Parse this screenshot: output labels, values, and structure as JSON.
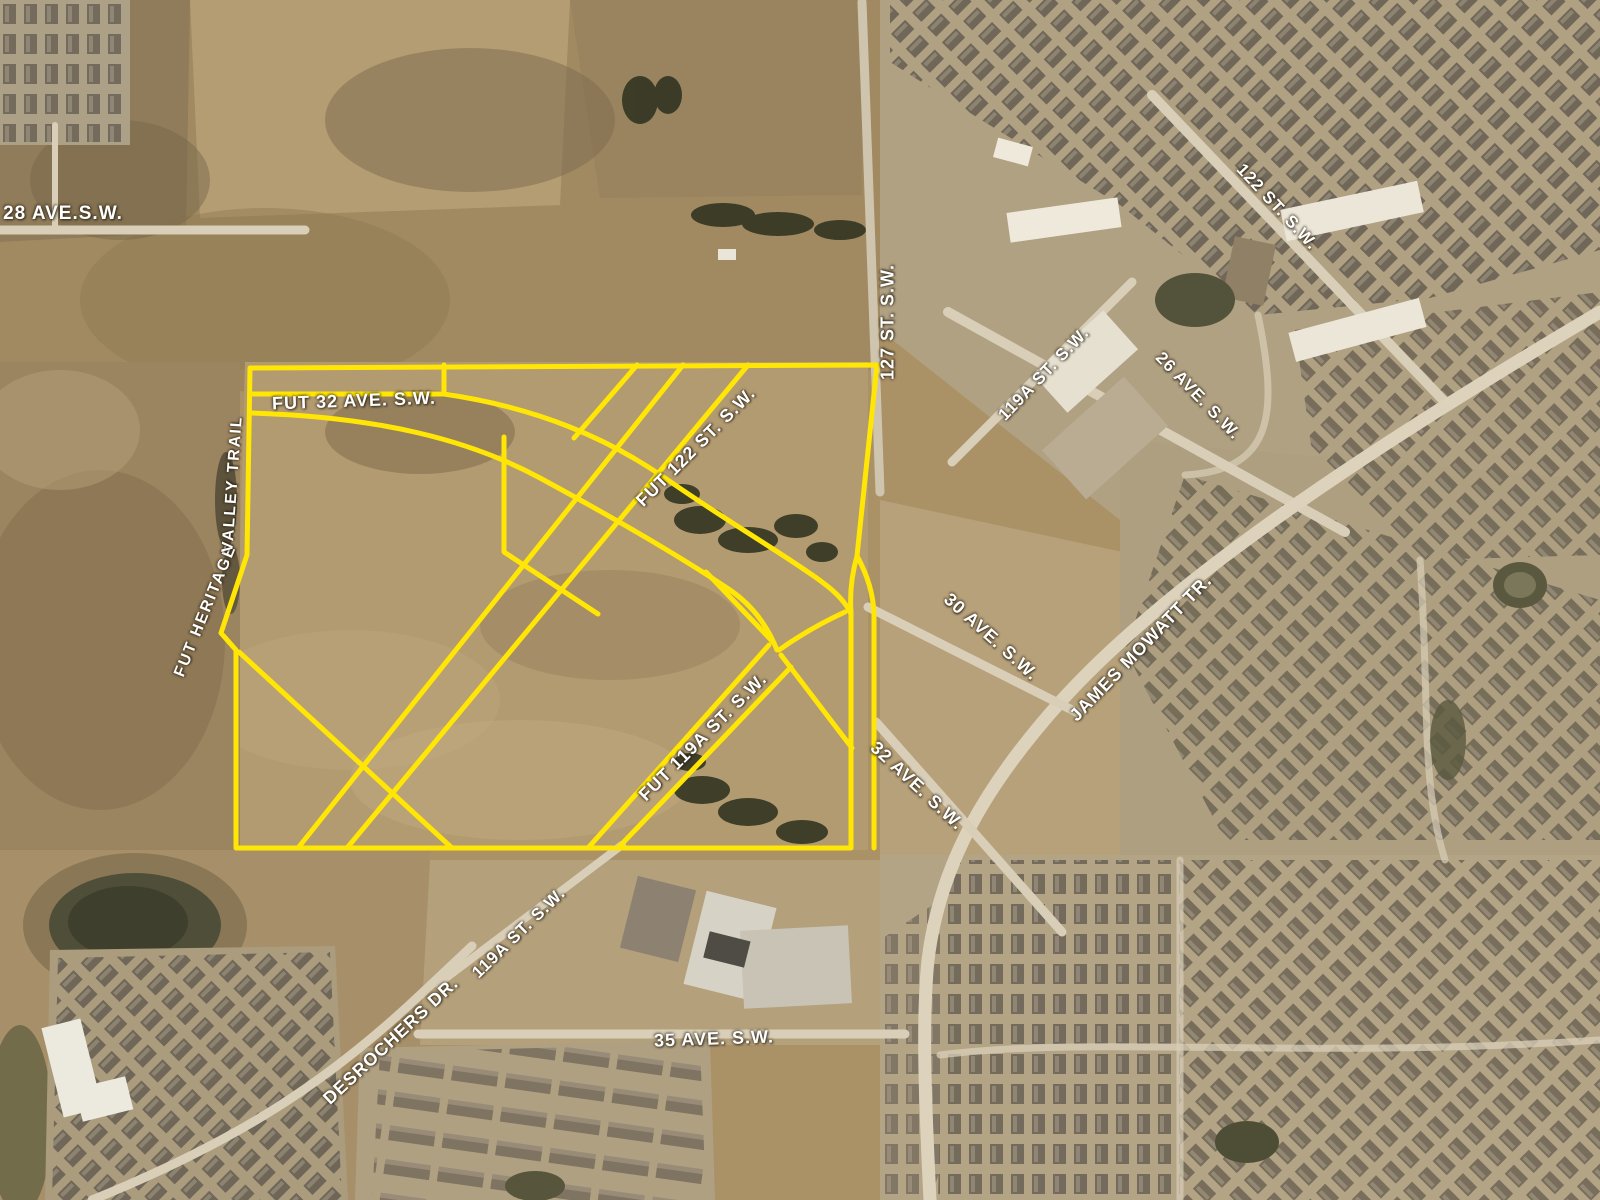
{
  "map": {
    "type": "aerial-imagery-with-development-boundary",
    "colors": {
      "annotation_yellow": "#ffe604",
      "label_white": "#ffffff"
    },
    "road_labels": [
      {
        "id": "ave-28",
        "text": "28 AVE.S.W."
      },
      {
        "id": "fut-32-ave",
        "text": "FUT 32 AVE. S.W."
      },
      {
        "id": "fut-heritage",
        "text": "FUT  HERITAGE"
      },
      {
        "id": "valley-trail",
        "text": "VALLEY  TRAIL"
      },
      {
        "id": "st-127",
        "text": "127 ST. S.W."
      },
      {
        "id": "fut-122-st",
        "text": "FUT 122 ST. S.W."
      },
      {
        "id": "st-119a-north",
        "text": "119A ST. S.W."
      },
      {
        "id": "ave-26",
        "text": "26 AVE. S.W."
      },
      {
        "id": "st-122",
        "text": "122 ST. S.W."
      },
      {
        "id": "ave-30",
        "text": "30 AVE. S.W."
      },
      {
        "id": "james-mowatt-tr",
        "text": "JAMES MOWATT TR."
      },
      {
        "id": "ave-32",
        "text": "32 AVE. S.W."
      },
      {
        "id": "fut-119a-st",
        "text": "FUT 119A ST. S.W."
      },
      {
        "id": "st-119a-south",
        "text": "119A ST. S.W."
      },
      {
        "id": "desrochers-dr",
        "text": "DESROCHERS DR."
      },
      {
        "id": "ave-35",
        "text": "35 AVE. S.W."
      }
    ]
  }
}
